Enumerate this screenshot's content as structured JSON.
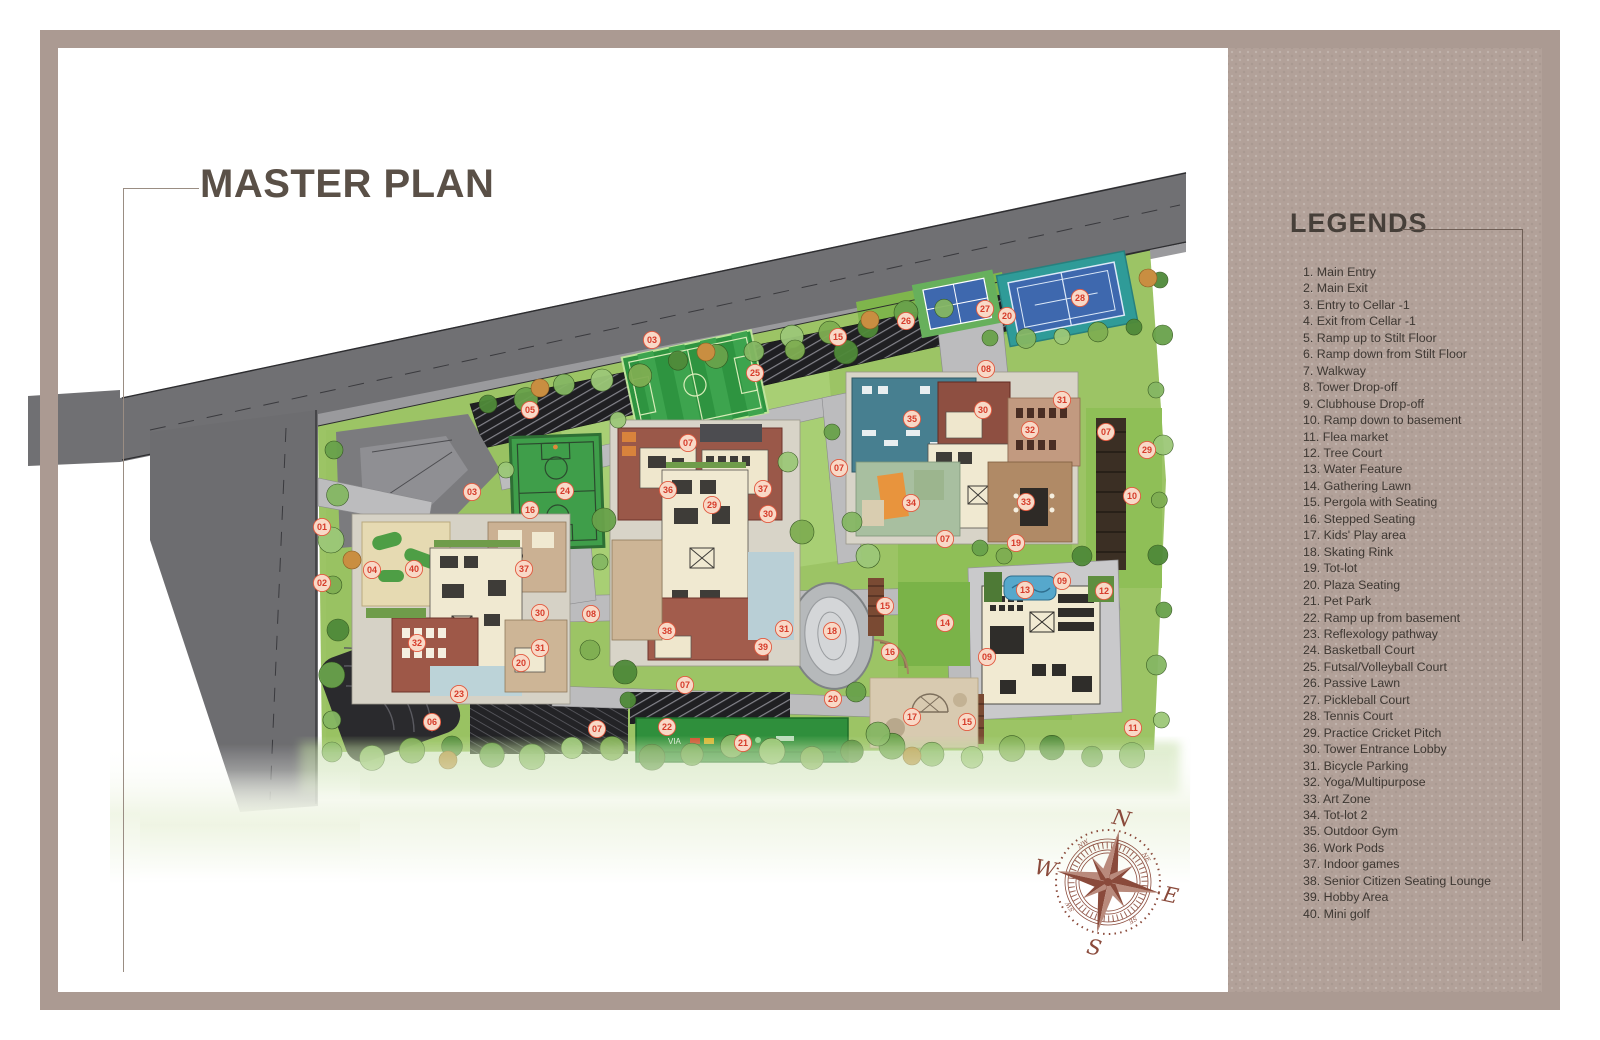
{
  "page": {
    "title": "MASTER PLAN",
    "legend_title": "LEGENDS"
  },
  "legend": {
    "items": [
      {
        "n": 1,
        "label": "Main Entry"
      },
      {
        "n": 2,
        "label": "Main Exit"
      },
      {
        "n": 3,
        "label": "Entry to Cellar -1"
      },
      {
        "n": 4,
        "label": "Exit from Cellar -1"
      },
      {
        "n": 5,
        "label": "Ramp up to Stilt Floor"
      },
      {
        "n": 6,
        "label": "Ramp down from Stilt Floor"
      },
      {
        "n": 7,
        "label": "Walkway"
      },
      {
        "n": 8,
        "label": "Tower Drop-off"
      },
      {
        "n": 9,
        "label": "Clubhouse Drop-off"
      },
      {
        "n": 10,
        "label": "Ramp down to basement"
      },
      {
        "n": 11,
        "label": "Flea market"
      },
      {
        "n": 12,
        "label": "Tree Court"
      },
      {
        "n": 13,
        "label": "Water Feature"
      },
      {
        "n": 14,
        "label": "Gathering Lawn"
      },
      {
        "n": 15,
        "label": "Pergola with Seating"
      },
      {
        "n": 16,
        "label": "Stepped Seating"
      },
      {
        "n": 17,
        "label": "Kids' Play area"
      },
      {
        "n": 18,
        "label": "Skating Rink"
      },
      {
        "n": 19,
        "label": "Tot-lot"
      },
      {
        "n": 20,
        "label": "Plaza Seating"
      },
      {
        "n": 21,
        "label": "Pet Park"
      },
      {
        "n": 22,
        "label": "Ramp up from basement"
      },
      {
        "n": 23,
        "label": "Reflexology pathway"
      },
      {
        "n": 24,
        "label": "Basketball Court"
      },
      {
        "n": 25,
        "label": "Futsal/Volleyball Court"
      },
      {
        "n": 26,
        "label": "Passive Lawn"
      },
      {
        "n": 27,
        "label": "Pickleball Court"
      },
      {
        "n": 28,
        "label": "Tennis Court"
      },
      {
        "n": 29,
        "label": "Practice Cricket Pitch"
      },
      {
        "n": 30,
        "label": "Tower Entrance Lobby"
      },
      {
        "n": 31,
        "label": "Bicycle Parking"
      },
      {
        "n": 32,
        "label": "Yoga/Multipurpose"
      },
      {
        "n": 33,
        "label": "Art Zone"
      },
      {
        "n": 34,
        "label": "Tot-lot 2"
      },
      {
        "n": 35,
        "label": "Outdoor Gym"
      },
      {
        "n": 36,
        "label": "Work Pods"
      },
      {
        "n": 37,
        "label": "Indoor games"
      },
      {
        "n": 38,
        "label": "Senior Citizen Seating Lounge"
      },
      {
        "n": 39,
        "label": "Hobby Area"
      },
      {
        "n": 40,
        "label": "Mini golf"
      }
    ]
  },
  "map": {
    "markers": [
      {
        "n": "01",
        "x": 322,
        "y": 527
      },
      {
        "n": "02",
        "x": 322,
        "y": 583
      },
      {
        "n": "03",
        "x": 652,
        "y": 340
      },
      {
        "n": "03",
        "x": 472,
        "y": 492
      },
      {
        "n": "04",
        "x": 372,
        "y": 570
      },
      {
        "n": "05",
        "x": 530,
        "y": 410
      },
      {
        "n": "06",
        "x": 432,
        "y": 722
      },
      {
        "n": "07",
        "x": 688,
        "y": 443
      },
      {
        "n": "07",
        "x": 839,
        "y": 468
      },
      {
        "n": "07",
        "x": 945,
        "y": 539
      },
      {
        "n": "07",
        "x": 1106,
        "y": 432
      },
      {
        "n": "07",
        "x": 685,
        "y": 685
      },
      {
        "n": "07",
        "x": 597,
        "y": 729
      },
      {
        "n": "08",
        "x": 986,
        "y": 369
      },
      {
        "n": "08",
        "x": 591,
        "y": 614
      },
      {
        "n": "09",
        "x": 1062,
        "y": 581
      },
      {
        "n": "09",
        "x": 987,
        "y": 657
      },
      {
        "n": "10",
        "x": 1132,
        "y": 496
      },
      {
        "n": "11",
        "x": 1133,
        "y": 728
      },
      {
        "n": "12",
        "x": 1104,
        "y": 591
      },
      {
        "n": "13",
        "x": 1025,
        "y": 590
      },
      {
        "n": "14",
        "x": 945,
        "y": 623
      },
      {
        "n": "15",
        "x": 838,
        "y": 337
      },
      {
        "n": "15",
        "x": 885,
        "y": 606
      },
      {
        "n": "15",
        "x": 967,
        "y": 722
      },
      {
        "n": "16",
        "x": 530,
        "y": 510
      },
      {
        "n": "16",
        "x": 890,
        "y": 652
      },
      {
        "n": "17",
        "x": 912,
        "y": 717
      },
      {
        "n": "18",
        "x": 832,
        "y": 631
      },
      {
        "n": "19",
        "x": 1016,
        "y": 543
      },
      {
        "n": "20",
        "x": 1007,
        "y": 316
      },
      {
        "n": "20",
        "x": 521,
        "y": 663
      },
      {
        "n": "20",
        "x": 833,
        "y": 699
      },
      {
        "n": "21",
        "x": 743,
        "y": 743
      },
      {
        "n": "22",
        "x": 667,
        "y": 727
      },
      {
        "n": "23",
        "x": 459,
        "y": 694
      },
      {
        "n": "24",
        "x": 565,
        "y": 491
      },
      {
        "n": "25",
        "x": 755,
        "y": 373
      },
      {
        "n": "26",
        "x": 906,
        "y": 321
      },
      {
        "n": "27",
        "x": 985,
        "y": 309
      },
      {
        "n": "28",
        "x": 1080,
        "y": 298
      },
      {
        "n": "29",
        "x": 1147,
        "y": 450
      },
      {
        "n": "29",
        "x": 712,
        "y": 505
      },
      {
        "n": "30",
        "x": 983,
        "y": 410
      },
      {
        "n": "30",
        "x": 768,
        "y": 514
      },
      {
        "n": "30",
        "x": 540,
        "y": 613
      },
      {
        "n": "31",
        "x": 1062,
        "y": 400
      },
      {
        "n": "31",
        "x": 784,
        "y": 629
      },
      {
        "n": "31",
        "x": 540,
        "y": 648
      },
      {
        "n": "32",
        "x": 1030,
        "y": 430
      },
      {
        "n": "32",
        "x": 417,
        "y": 643
      },
      {
        "n": "33",
        "x": 1026,
        "y": 502
      },
      {
        "n": "34",
        "x": 911,
        "y": 503
      },
      {
        "n": "35",
        "x": 912,
        "y": 419
      },
      {
        "n": "36",
        "x": 668,
        "y": 490
      },
      {
        "n": "37",
        "x": 763,
        "y": 489
      },
      {
        "n": "37",
        "x": 524,
        "y": 569
      },
      {
        "n": "38",
        "x": 667,
        "y": 631
      },
      {
        "n": "39",
        "x": 763,
        "y": 647
      },
      {
        "n": "40",
        "x": 414,
        "y": 569
      }
    ]
  },
  "compass": {
    "north": "N",
    "east": "E",
    "south": "S",
    "west": "W",
    "minor": [
      "NE",
      "SE",
      "SW",
      "NW"
    ]
  },
  "colors": {
    "frame": "#ab9a92",
    "panel": "#b2a199",
    "title": "#5a5047",
    "marker_fill": "#f8d9c7",
    "marker_stroke": "#e2593f",
    "marker_text": "#d63b2a",
    "road": "#707073",
    "lawn": "#9cc465",
    "court_blue": "#3e68ae",
    "court_green": "#3f9e4a",
    "building_red": "#9a5849",
    "building_cream": "#f0e9d1",
    "deck_teal": "#477f90",
    "compass": "#8a4a3b"
  }
}
